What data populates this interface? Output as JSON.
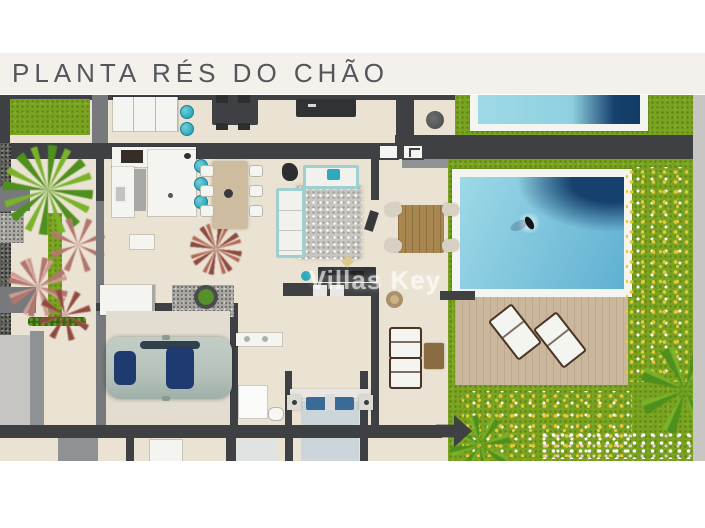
{
  "page": {
    "title": "PLANTA RÉS DO CHÃO",
    "watermark": "Villas Key"
  },
  "plan": {
    "areas": [
      "garden",
      "kitchen",
      "dining-area",
      "living-room",
      "outdoor-dining-terrace",
      "swimming-pool",
      "pool-deck",
      "garage-driveway",
      "bedroom",
      "bathroom",
      "neighbouring-pool",
      "flower-beds"
    ],
    "objects": [
      "u-shaped-kitchen-counter",
      "bar-stools",
      "dining-table-6-chairs",
      "l-shaped-sofa",
      "shag-rug",
      "tv-media-unit",
      "outdoor-wood-table",
      "sun-loungers",
      "swimmer",
      "parked-car",
      "double-bed-blue-pillows",
      "shower",
      "toilet",
      "vanity",
      "palm-trees",
      "potted-plants",
      "round-basket"
    ]
  },
  "colors": {
    "title-bg": "#f4f1ec",
    "title-text": "#55565a",
    "floor": "#eae2d2",
    "wall-dark": "#3e4043",
    "wall-mid": "#8f9294",
    "wall-gray": "#77797c",
    "wall-light": "#c7c6c3",
    "grass": "#7aa321",
    "gravel": "#a9a7a2",
    "concrete": "#e3ddd1",
    "deck": "#cbb79c",
    "wood": "#a8864f",
    "wood-dark": "#4a3426",
    "teal": "#2fa9bd",
    "aqua": "#9fd0cf",
    "white-furn": "#f4f4f1",
    "rug": "#c9c6c1",
    "pool-light": "#9ed9e7",
    "pool-mid": "#5fb0d2",
    "pool-dark": "#16416e",
    "flower-yellow": "#e6c83d",
    "blue-pillow": "#3a6b96",
    "duvet": "#ccd6da",
    "car-body": "#b5c2ba",
    "car-glass": "#1e3a6e",
    "leaf-green": "#4e8f1d",
    "leaf-light": "#7ab22a",
    "leaf-pink": "#b2766f",
    "leaf-pink-light": "#cf9a90",
    "leaf-red": "#8e4a40",
    "leaf-red-light": "#b06a58",
    "watermark": "rgba(255,255,255,0.62)"
  }
}
